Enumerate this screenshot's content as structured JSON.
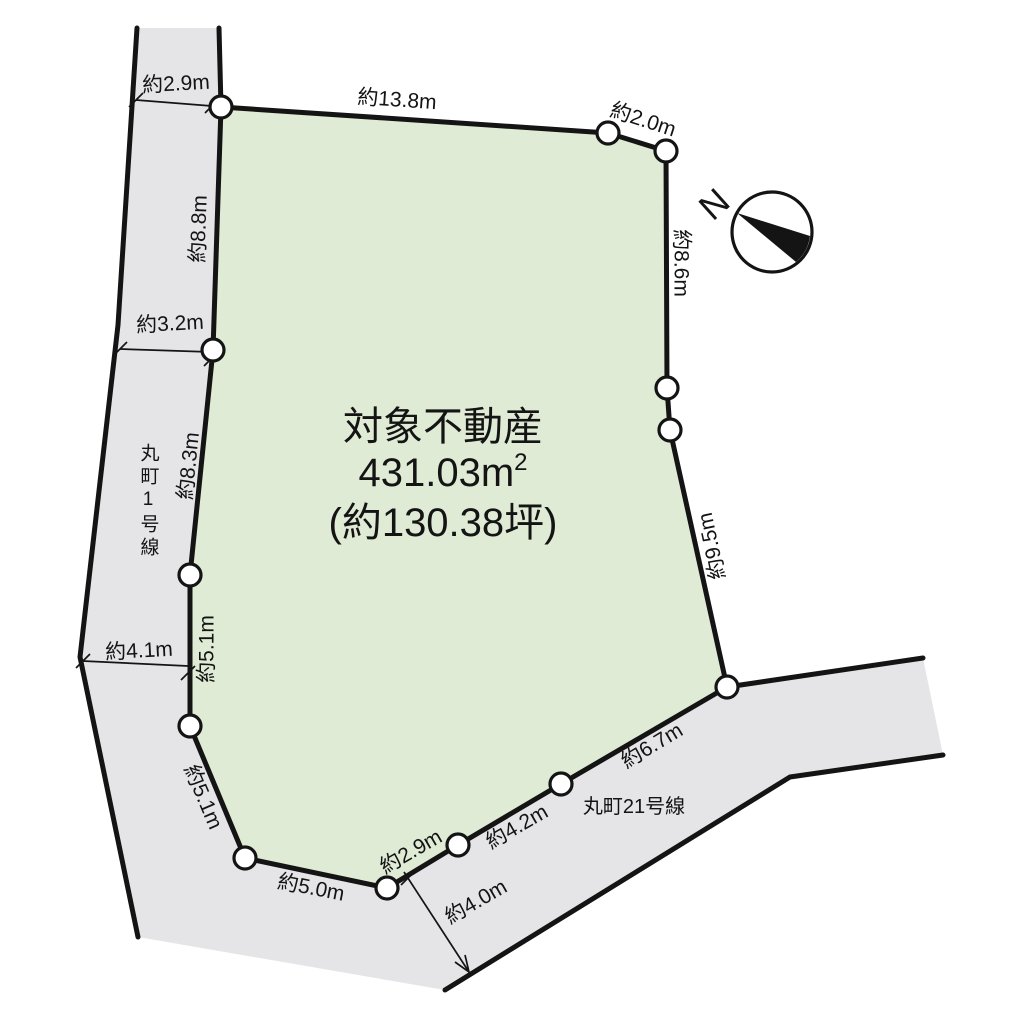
{
  "parcel": {
    "title": "対象不動産",
    "area_value": "431.03m",
    "area_sup": "2",
    "area_tsubo": "(約130.38坪)"
  },
  "roads": {
    "road1_label": "丸町1号線",
    "road21_label": "丸町21号線"
  },
  "compass": {
    "north": "N"
  },
  "dimensions": {
    "top_road_width": "約2.9m",
    "top_edge": "約13.8m",
    "ne_corner_edge": "約2.0m",
    "left_edge_n": "約8.8m",
    "left_road_width_mid": "約3.2m",
    "left_edge_mid": "約8.3m",
    "right_edge_n": "約8.6m",
    "right_edge_s": "約9.5m",
    "left_edge_s": "約5.1m",
    "left_road_width_s": "約4.1m",
    "sw_diag_edge": "約5.1m",
    "bottom_edge_w": "約5.0m",
    "bottom_edge_1": "約2.9m",
    "bottom_edge_2": "約4.2m",
    "bottom_edge_3": "約6.7m",
    "bottom_road_width": "約4.0m"
  },
  "colors": {
    "plot_fill": "#dfebd5",
    "road_fill": "#e5e5e7",
    "ink": "#141414"
  }
}
